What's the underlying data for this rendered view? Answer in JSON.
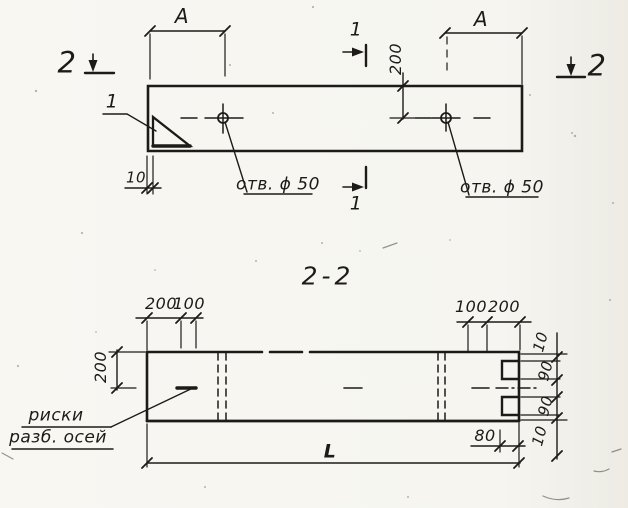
{
  "page": {
    "paper_color": "#f6f5f0",
    "ink_color": "#1c1b18"
  },
  "plan_view": {
    "dim_a_left": "A",
    "dim_a_right": "A",
    "section_marker_2_left": "2",
    "section_marker_2_right": "2",
    "section_marker_1_top": "1",
    "section_marker_1_bottom": "1",
    "detail_callout": "1",
    "dim_edge_to_hole": "200",
    "dim_chamfer": "10",
    "hole_label_left": "отв. ϕ 50",
    "hole_label_right": "отв. ϕ 50"
  },
  "section_view": {
    "title": "2-2",
    "top_dims_left": [
      "200",
      "100"
    ],
    "top_dims_right": [
      "100",
      "200"
    ],
    "dim_height": "200",
    "right_dims": [
      "10",
      "90",
      "90",
      "10"
    ],
    "dim_notch_depth": "80",
    "dim_length": "L",
    "axis_marks_label_line1": "риски",
    "axis_marks_label_line2": "разб. осей"
  }
}
